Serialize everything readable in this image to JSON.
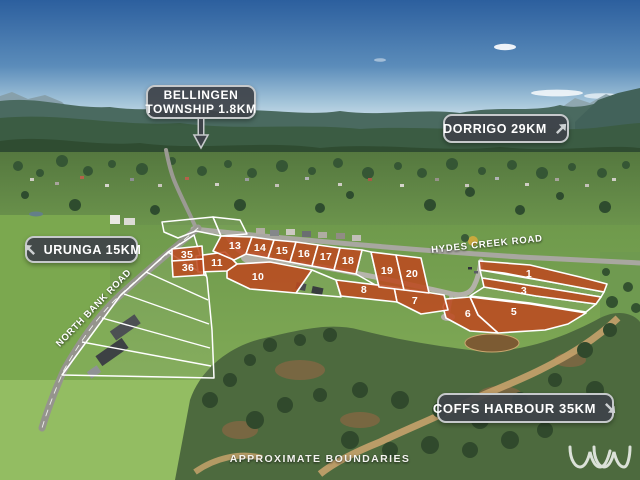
{
  "signs": {
    "bellingen": {
      "line1": "BELLINGEN",
      "line2": "TOWNSHIP 1.8KM",
      "arrow": "pointer-down"
    },
    "dorrigo": {
      "label": "DORRIGO 29KM",
      "arrow": "up-right"
    },
    "urunga": {
      "label": "URUNGA 15KM",
      "arrow": "up-left"
    },
    "coffs_harbour": {
      "label": "COFFS HARBOUR 35KM",
      "arrow": "down-right"
    }
  },
  "roads": {
    "hydes_creek": "HYDES CREEK ROAD",
    "north_bank": "NORTH BANK ROAD"
  },
  "footer": {
    "note": "APPROXIMATE BOUNDARIES"
  },
  "colors": {
    "lot_fill": "#bc4a20",
    "lot_border": "#ffffff",
    "sign_bg": "#3e4349",
    "sign_border": "#c6c9cb"
  },
  "lots": [
    {
      "number": "1",
      "points": "479,261 530,265 580,277 607,284 604,292 556,283 504,273 480,270",
      "label": [
        529,
        274
      ]
    },
    {
      "number": "3",
      "points": "482,278 540,287 601,297 596,304 536,296 484,287",
      "label": [
        524,
        291
      ]
    },
    {
      "number": "5",
      "points": "470,297 530,304 586,313 568,324 545,330 498,333 478,315",
      "label": [
        514,
        312
      ]
    },
    {
      "number": "6",
      "points": "446,299 470,297 478,315 498,333 470,331 446,318 443,307",
      "label": [
        468,
        314
      ]
    },
    {
      "number": "7",
      "points": "394,287 444,295 448,310 421,314 397,302",
      "label": [
        415,
        301
      ]
    },
    {
      "number": "8",
      "points": "336,280 394,287 397,302 341,296",
      "label": [
        364,
        290
      ]
    },
    {
      "number": "10",
      "points": "227,271 237,264 270,262 312,270 296,293 250,289 227,278",
      "label": [
        258,
        277
      ]
    },
    {
      "number": "11",
      "points": "196,256 225,252 237,264 227,271 198,272",
      "label": [
        217,
        263
      ]
    },
    {
      "number": "13",
      "points": "213,251 221,236 252,237 246,254 234,260",
      "label": [
        235,
        246
      ]
    },
    {
      "number": "14",
      "points": "252,237 274,240 268,258 246,254",
      "label": [
        260,
        248
      ]
    },
    {
      "number": "15",
      "points": "274,240 296,242 290,262 268,258",
      "label": [
        282,
        251
      ]
    },
    {
      "number": "16",
      "points": "296,242 318,245 312,266 290,262",
      "label": [
        304,
        254
      ]
    },
    {
      "number": "17",
      "points": "318,245 340,248 334,270 312,266",
      "label": [
        326,
        257
      ]
    },
    {
      "number": "18",
      "points": "340,248 362,250 356,274 334,270",
      "label": [
        348,
        261
      ]
    },
    {
      "number": "19",
      "points": "371,252 396,255 404,290 379,287",
      "label": [
        387,
        271
      ]
    },
    {
      "number": "20",
      "points": "396,255 421,258 429,293 404,290",
      "label": [
        412,
        274
      ]
    },
    {
      "number": "35",
      "points": "172,249 202,246 203,259 172,261",
      "label": [
        187,
        255
      ]
    },
    {
      "number": "36",
      "points": "172,261 203,259 204,275 173,277",
      "label": [
        188,
        268
      ]
    }
  ]
}
